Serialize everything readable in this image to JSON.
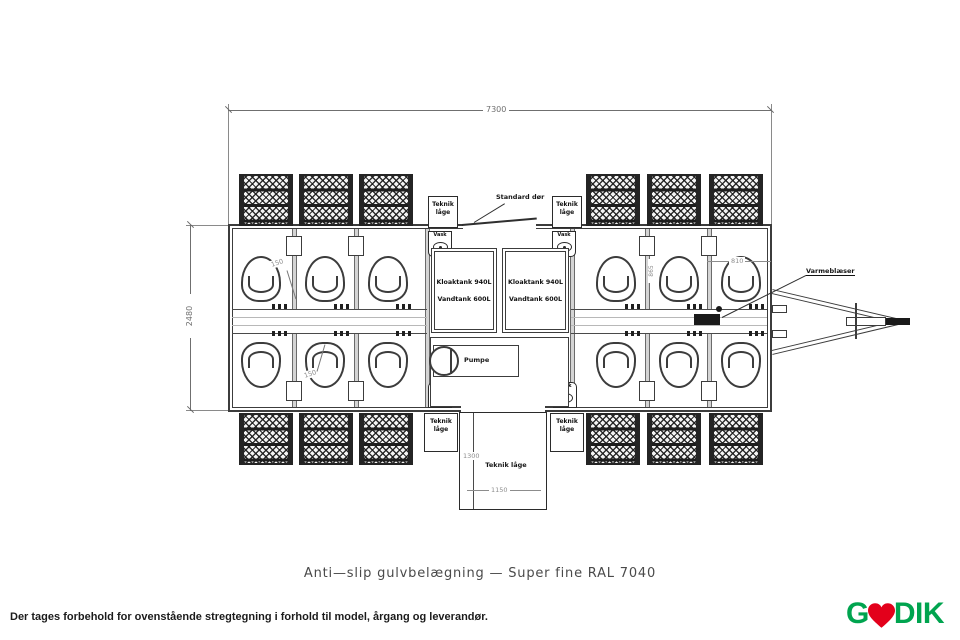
{
  "page": {
    "title_note": "Anti—slip gulvbelægning — Super fine RAL 7040",
    "footer_disclaimer": "Der tages forbehold for ovenstående stregtegning i forhold til model, årgang og leverandør.",
    "logo": {
      "text_before": "G",
      "heart_icon": "heart",
      "text_after": "DIK",
      "green": "#00a44f",
      "red": "#e3001b"
    }
  },
  "plan": {
    "labels": {
      "teknik_laage": "Teknik låge",
      "standard_door": "Standard dør",
      "vask": "Vask",
      "kloaktank": "Kloaktank 940L",
      "vandtank": "Vandtank 600L",
      "pumpe": "Pumpe",
      "varmeblaeser": "Varmeblæser"
    },
    "dimensions": {
      "overall_width": "7300",
      "overall_depth": "2480",
      "stall_width": "810",
      "stall_depth": "865",
      "toilet_offset": "150",
      "teknik_depth": "1300",
      "teknik_width": "1150"
    },
    "colors": {
      "line": "#3c3c3c"
    }
  }
}
